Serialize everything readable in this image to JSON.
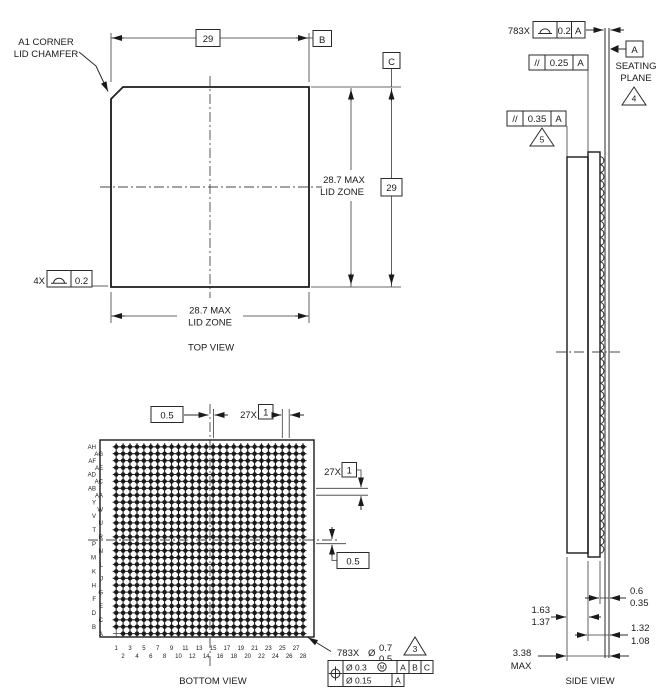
{
  "drawing": {
    "top_view": {
      "label": "TOP VIEW",
      "a1_note_line1": "A1 CORNER",
      "a1_note_line2": "LID CHAMFER",
      "width_basic": "29",
      "height_basic": "29",
      "datum_b": "B",
      "datum_c": "C",
      "lid_zone_right_line1": "28.7 MAX",
      "lid_zone_right_line2": "LID ZONE",
      "lid_zone_bottom_line1": "28.7 MAX",
      "lid_zone_bottom_line2": "LID ZONE",
      "corner_count": "4X",
      "corner_tolerance": "0.2"
    },
    "bottom_view": {
      "label": "BOTTOM VIEW",
      "offset_top": "0.5",
      "offset_right": "0.5",
      "pitch_count_top": "27X",
      "pitch_top": "1",
      "pitch_count_right": "27X",
      "pitch_right": "1",
      "ball_count": "783X",
      "ball_dia_symbol": "Ø",
      "ball_dia_max": "0.7",
      "ball_dia_min": "0.5",
      "flag_3": "3",
      "fcf_r1_dia": "Ø 0.3",
      "fcf_r1_mod": "M",
      "fcf_r1_d1": "A",
      "fcf_r1_d2": "B",
      "fcf_r1_d3": "C",
      "fcf_r2_dia": "Ø 0.15",
      "fcf_r2_d1": "A",
      "grid": {
        "rows": 28,
        "cols": 28,
        "missing_ball": "A1"
      },
      "row_labels": [
        "AH",
        "AG",
        "AF",
        "AE",
        "AD",
        "AC",
        "AB",
        "AA",
        "Y",
        "W",
        "V",
        "U",
        "T",
        "R",
        "P",
        "N",
        "M",
        "L",
        "K",
        "J",
        "H",
        "G",
        "F",
        "E",
        "D",
        "C",
        "B",
        "A"
      ],
      "col_labels": [
        "1",
        "2",
        "3",
        "4",
        "5",
        "6",
        "7",
        "8",
        "9",
        "10",
        "11",
        "12",
        "13",
        "14",
        "15",
        "16",
        "17",
        "18",
        "19",
        "20",
        "21",
        "22",
        "23",
        "24",
        "25",
        "26",
        "27",
        "28"
      ]
    },
    "side_view": {
      "label": "SIDE VIEW",
      "coplanarity_count": "783X",
      "coplanarity_tolerance": "0.2",
      "coplanarity_datum": "A",
      "datum_a": "A",
      "seating_line1": "SEATING",
      "seating_line2": "PLANE",
      "flag_4": "4",
      "flag_5": "5",
      "parallelism_symbol": "//",
      "parallelism_1_tolerance": "0.25",
      "parallelism_1_datum": "A",
      "parallelism_2_tolerance": "0.35",
      "parallelism_2_datum": "A",
      "ball_height_max": "0.6",
      "ball_height_min": "0.35",
      "lid_thickness_max": "1.63",
      "lid_thickness_min": "1.37",
      "body_thickness_max": "1.32",
      "body_thickness_min": "1.08",
      "total_height": "3.38",
      "total_height_qual": "MAX"
    },
    "colors": {
      "line": "#222222",
      "ball_fill": "#1b1b1b",
      "background": "#ffffff"
    }
  }
}
